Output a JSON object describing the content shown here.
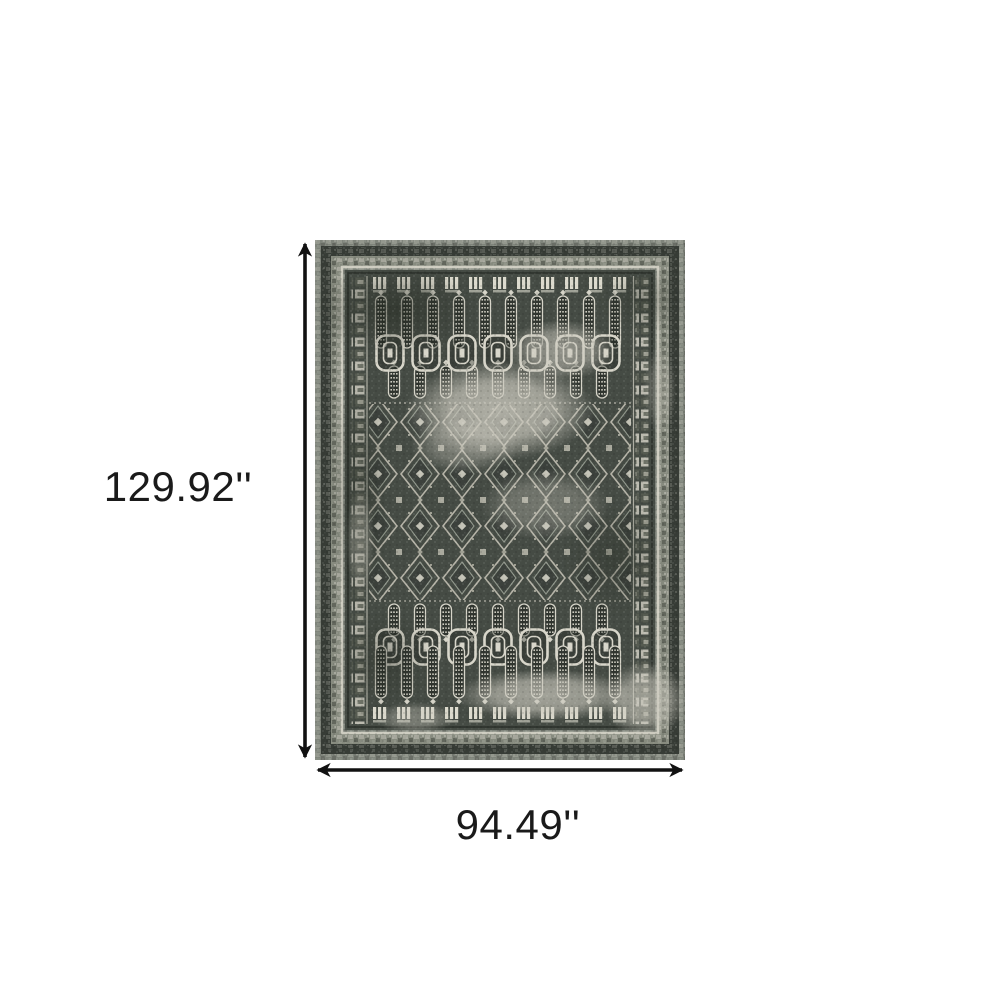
{
  "diagram": {
    "type": "product-dimension-diagram",
    "product": "distressed oriental area rug",
    "height_label": "129.92''",
    "width_label": "94.49''"
  },
  "colors": {
    "arrow": "#111111",
    "label_text": "#1a1a1a",
    "rug_base": "#7f847b",
    "rug_dark": "#373c36",
    "rug_mid": "#878b7f",
    "rug_field": "#454b44",
    "rug_ivory": "#d7d5c9",
    "rug_wear": "#cac8bd"
  }
}
